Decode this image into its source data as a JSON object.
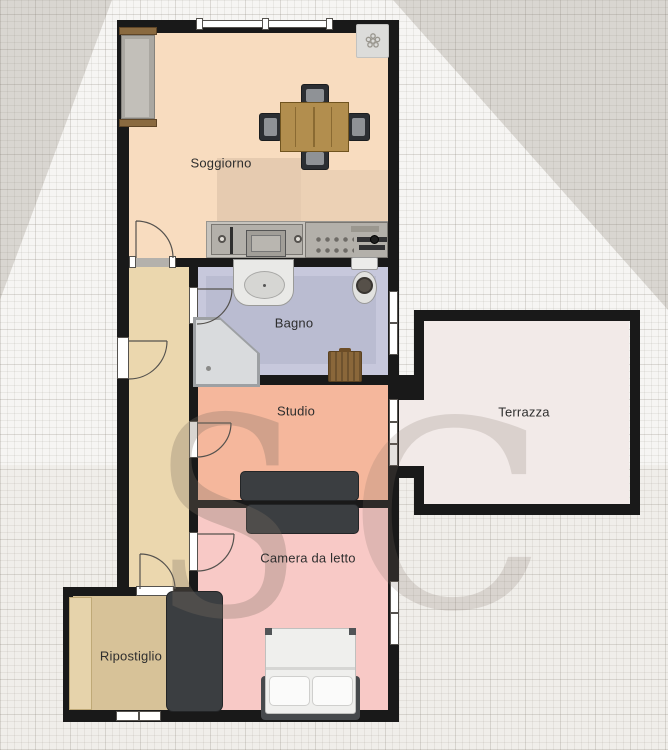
{
  "plan_title": "Apartment floor plan",
  "rooms": {
    "soggiorno": {
      "label": "Soggiorno",
      "color": "#f8dcbf"
    },
    "bagno": {
      "label": "Bagno",
      "color": "#c7c8dc"
    },
    "studio": {
      "label": "Studio",
      "color": "#f5b79c"
    },
    "terrazza": {
      "label": "Terrazza",
      "color": "#f2eae8"
    },
    "camera": {
      "label": "Camera da letto",
      "color": "#f8c9c6"
    },
    "ripostiglio": {
      "label": "Ripostiglio",
      "color": "#d7c298"
    },
    "corridoio": {
      "color": "#ebd7ae"
    }
  },
  "watermark": {
    "letter_s": "S",
    "letter_c": "C",
    "color": "rgba(125,112,100,0.30)"
  },
  "palette": {
    "wall": "#191919",
    "background": "#f0eeea",
    "background_dark": "#d9d6d1",
    "background_light": "#fbfbf9",
    "window_frame": "#ffffff",
    "furniture_dark": "#3b3e41",
    "wood": "#b28e4e"
  },
  "furniture": [
    {
      "name": "sofa",
      "room": "soggiorno"
    },
    {
      "name": "dining-table",
      "room": "soggiorno"
    },
    {
      "name": "dining-chairs",
      "room": "soggiorno",
      "count": 4
    },
    {
      "name": "ac-unit",
      "room": "soggiorno"
    },
    {
      "name": "kitchen-counter-oven",
      "room": "soggiorno"
    },
    {
      "name": "kitchen-counter-sink",
      "room": "soggiorno"
    },
    {
      "name": "washbasin",
      "room": "bagno"
    },
    {
      "name": "toilet",
      "room": "bagno"
    },
    {
      "name": "corner-shower",
      "room": "bagno"
    },
    {
      "name": "laundry-basket",
      "room": "bagno"
    },
    {
      "name": "wardrobe",
      "room": "studio"
    },
    {
      "name": "wardrobe",
      "room": "camera"
    },
    {
      "name": "wardrobe",
      "room": "ripostiglio"
    },
    {
      "name": "shelf",
      "room": "ripostiglio"
    },
    {
      "name": "double-bed",
      "room": "camera"
    }
  ],
  "counts": {
    "windows": 5,
    "doors": 6,
    "french_doors": 1
  }
}
